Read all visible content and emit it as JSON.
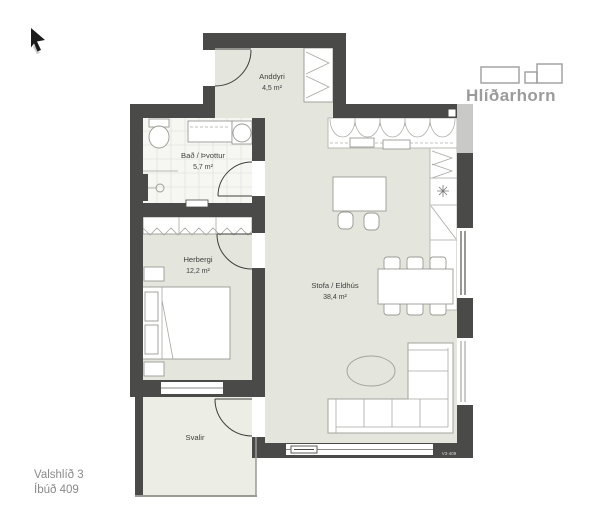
{
  "brand": {
    "name": "Hlíðarhorn",
    "color": "#9b9b9b"
  },
  "footer": {
    "address": "Valshlíð 3",
    "unit": "Íbúð 409"
  },
  "plan": {
    "tag": "V3-409",
    "colors": {
      "wall": "#4a4a48",
      "floor": "#e4e5dc",
      "balcony_floor": "#ecede4",
      "bath_floor": "#f6f6f2",
      "neighbor_wall": "#c9c9c7",
      "furniture_stroke": "#9a9a95",
      "label_text": "#3f3f3f"
    },
    "rooms": [
      {
        "key": "anddyri",
        "name": "Anddyri",
        "area": "4,5 m²"
      },
      {
        "key": "bath",
        "name": "Bað / Þvottur",
        "area": "5,7 m²"
      },
      {
        "key": "bedroom",
        "name": "Herbergi",
        "area": "12,2 m²"
      },
      {
        "key": "living",
        "name": "Stofa / Eldhús",
        "area": "38,4 m²"
      },
      {
        "key": "balcony",
        "name": "Svalir",
        "area": ""
      }
    ]
  }
}
